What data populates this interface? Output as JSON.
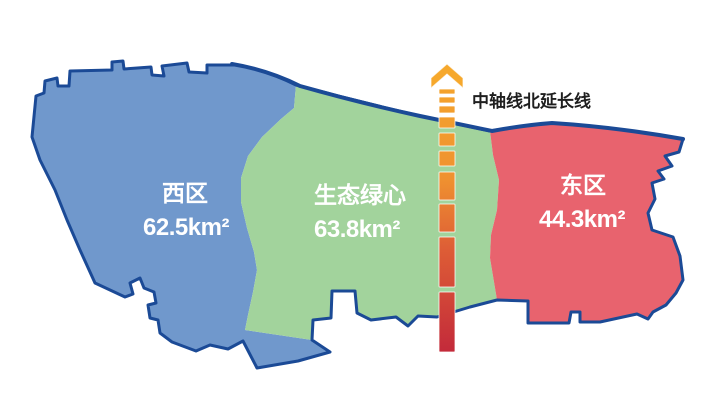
{
  "map": {
    "background": "#ffffff",
    "border_color": "#1b4a96",
    "label_color": "#ffffff"
  },
  "regions": [
    {
      "name": "西区",
      "area": "62.5km²",
      "area_km2": 62.5,
      "color": "#7098cc"
    },
    {
      "name": "生态绿心",
      "area": "63.8km²",
      "area_km2": 63.8,
      "color": "#a2d39c"
    },
    {
      "name": "东区",
      "area": "44.3km²",
      "area_km2": 44.3,
      "color": "#e8636e"
    }
  ],
  "axis_line": {
    "label": "中轴线北延长线",
    "label_color": "#1f1f1f",
    "gradient_stops": [
      "#f6a82c",
      "#ef9130",
      "#dd5c36",
      "#c32a3a"
    ]
  }
}
